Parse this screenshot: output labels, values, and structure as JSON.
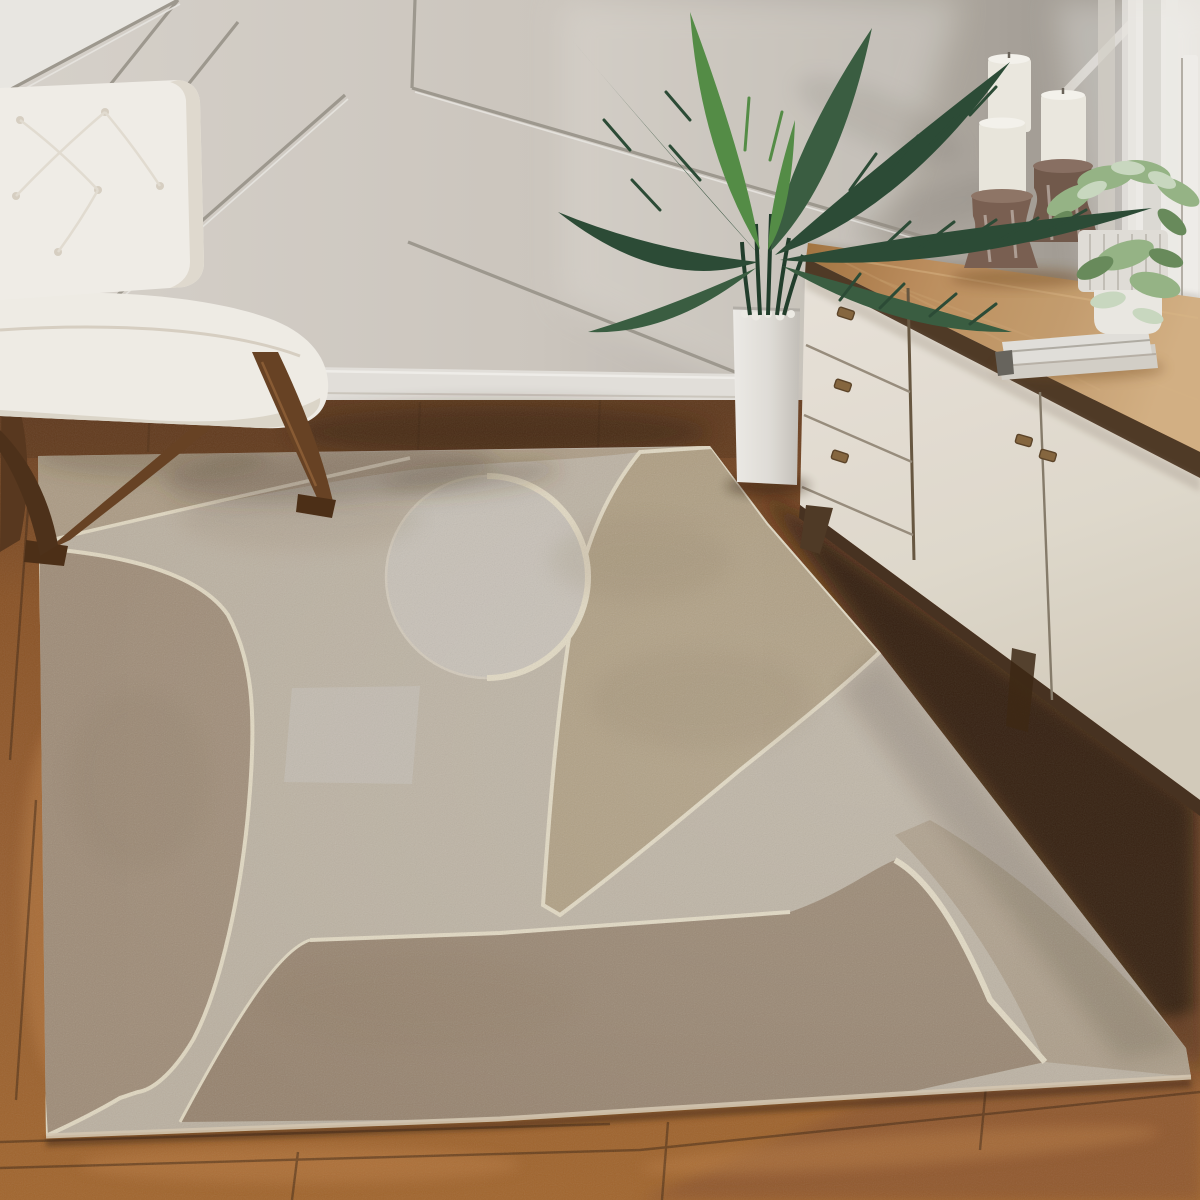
{
  "meta": {
    "kind": "interior-photograph",
    "subject": "living room corner with geometric area rug, accent chair, palm plant and mid-century sideboard",
    "width_px": 1200,
    "height_px": 1200
  },
  "palette": {
    "ceiling": "#f0eee9",
    "wall": "#d6d1c9",
    "wall_groove": "#a39d93",
    "wall_dark": "#9a948b",
    "baseboard": "#e9e6e0",
    "floor": "#9c6231",
    "floor_dark": "#5f3a1e",
    "floor_light": "#c08046",
    "floor_shadow": "#241607",
    "rug_base": "#c2b7a7",
    "rug_top_band": "#b2a189",
    "rug_tan_band": "#b3a284",
    "rug_left_arch": "#a5917c",
    "rug_circle": "#cdc6bb",
    "rug_dark_block": "#9c8872",
    "rug_corner_band": "#b1a28c",
    "rug_light_panel": "#c9c2b6",
    "rug_cream_line": "#e9dfc8",
    "chair_upholstery": "#f6f3ec",
    "chair_wood": "#6b4526",
    "cabinet_face": "#eae4d9",
    "cabinet_wood_top": "#bb8c5a",
    "cabinet_trim": "#523c28",
    "knob_brass": "#8a6a42",
    "planter": "#e9e7e2",
    "candle_wax": "#f2efe6",
    "candle_holder_wood": "#7d6354",
    "palm_dark": "#2e4e38",
    "palm_mid": "#3c6144",
    "palm_bright": "#579149",
    "pot_white": "#f1efe9",
    "foliage_light": "#9ab98a",
    "book_cover": "#e8e6e0",
    "window_light": "#efece6",
    "curtain": "#d9d5ce"
  },
  "scene": {
    "objects": [
      {
        "name": "accent chair",
        "upholstery": "white tufted leather",
        "frame": "walnut X-legs",
        "position": "left foreground"
      },
      {
        "name": "area rug",
        "style": "mid-century abstract — circle, arches and arcs",
        "colors": "beige, taupe, brown, cream outlines",
        "position": "center floor"
      },
      {
        "name": "palm plant",
        "planter": "tall white rectangular planter with white pebbles",
        "position": "center, against wall"
      },
      {
        "name": "sideboard",
        "top": "warm oak slab",
        "front": "cream lacquer",
        "drawers_visible": 3,
        "doors_visible": 2,
        "knobs_visible": 5,
        "legs": "splayed walnut",
        "position": "right"
      },
      {
        "name": "pillar candles",
        "count": 3,
        "holders": "rustic turned-wood candle holders",
        "position": "on sideboard top"
      },
      {
        "name": "potted greenery",
        "pots": 2,
        "resting_on": "stack of books",
        "position": "on sideboard, by window"
      },
      {
        "name": "window",
        "treatment": "sheer curtain, bright daylight",
        "position": "far right"
      },
      {
        "name": "accent wall",
        "finish": "greige board-and-batten with diagonal trim",
        "position": "background"
      },
      {
        "name": "floor",
        "material": "warm walnut planks",
        "position": "foreground"
      }
    ]
  }
}
